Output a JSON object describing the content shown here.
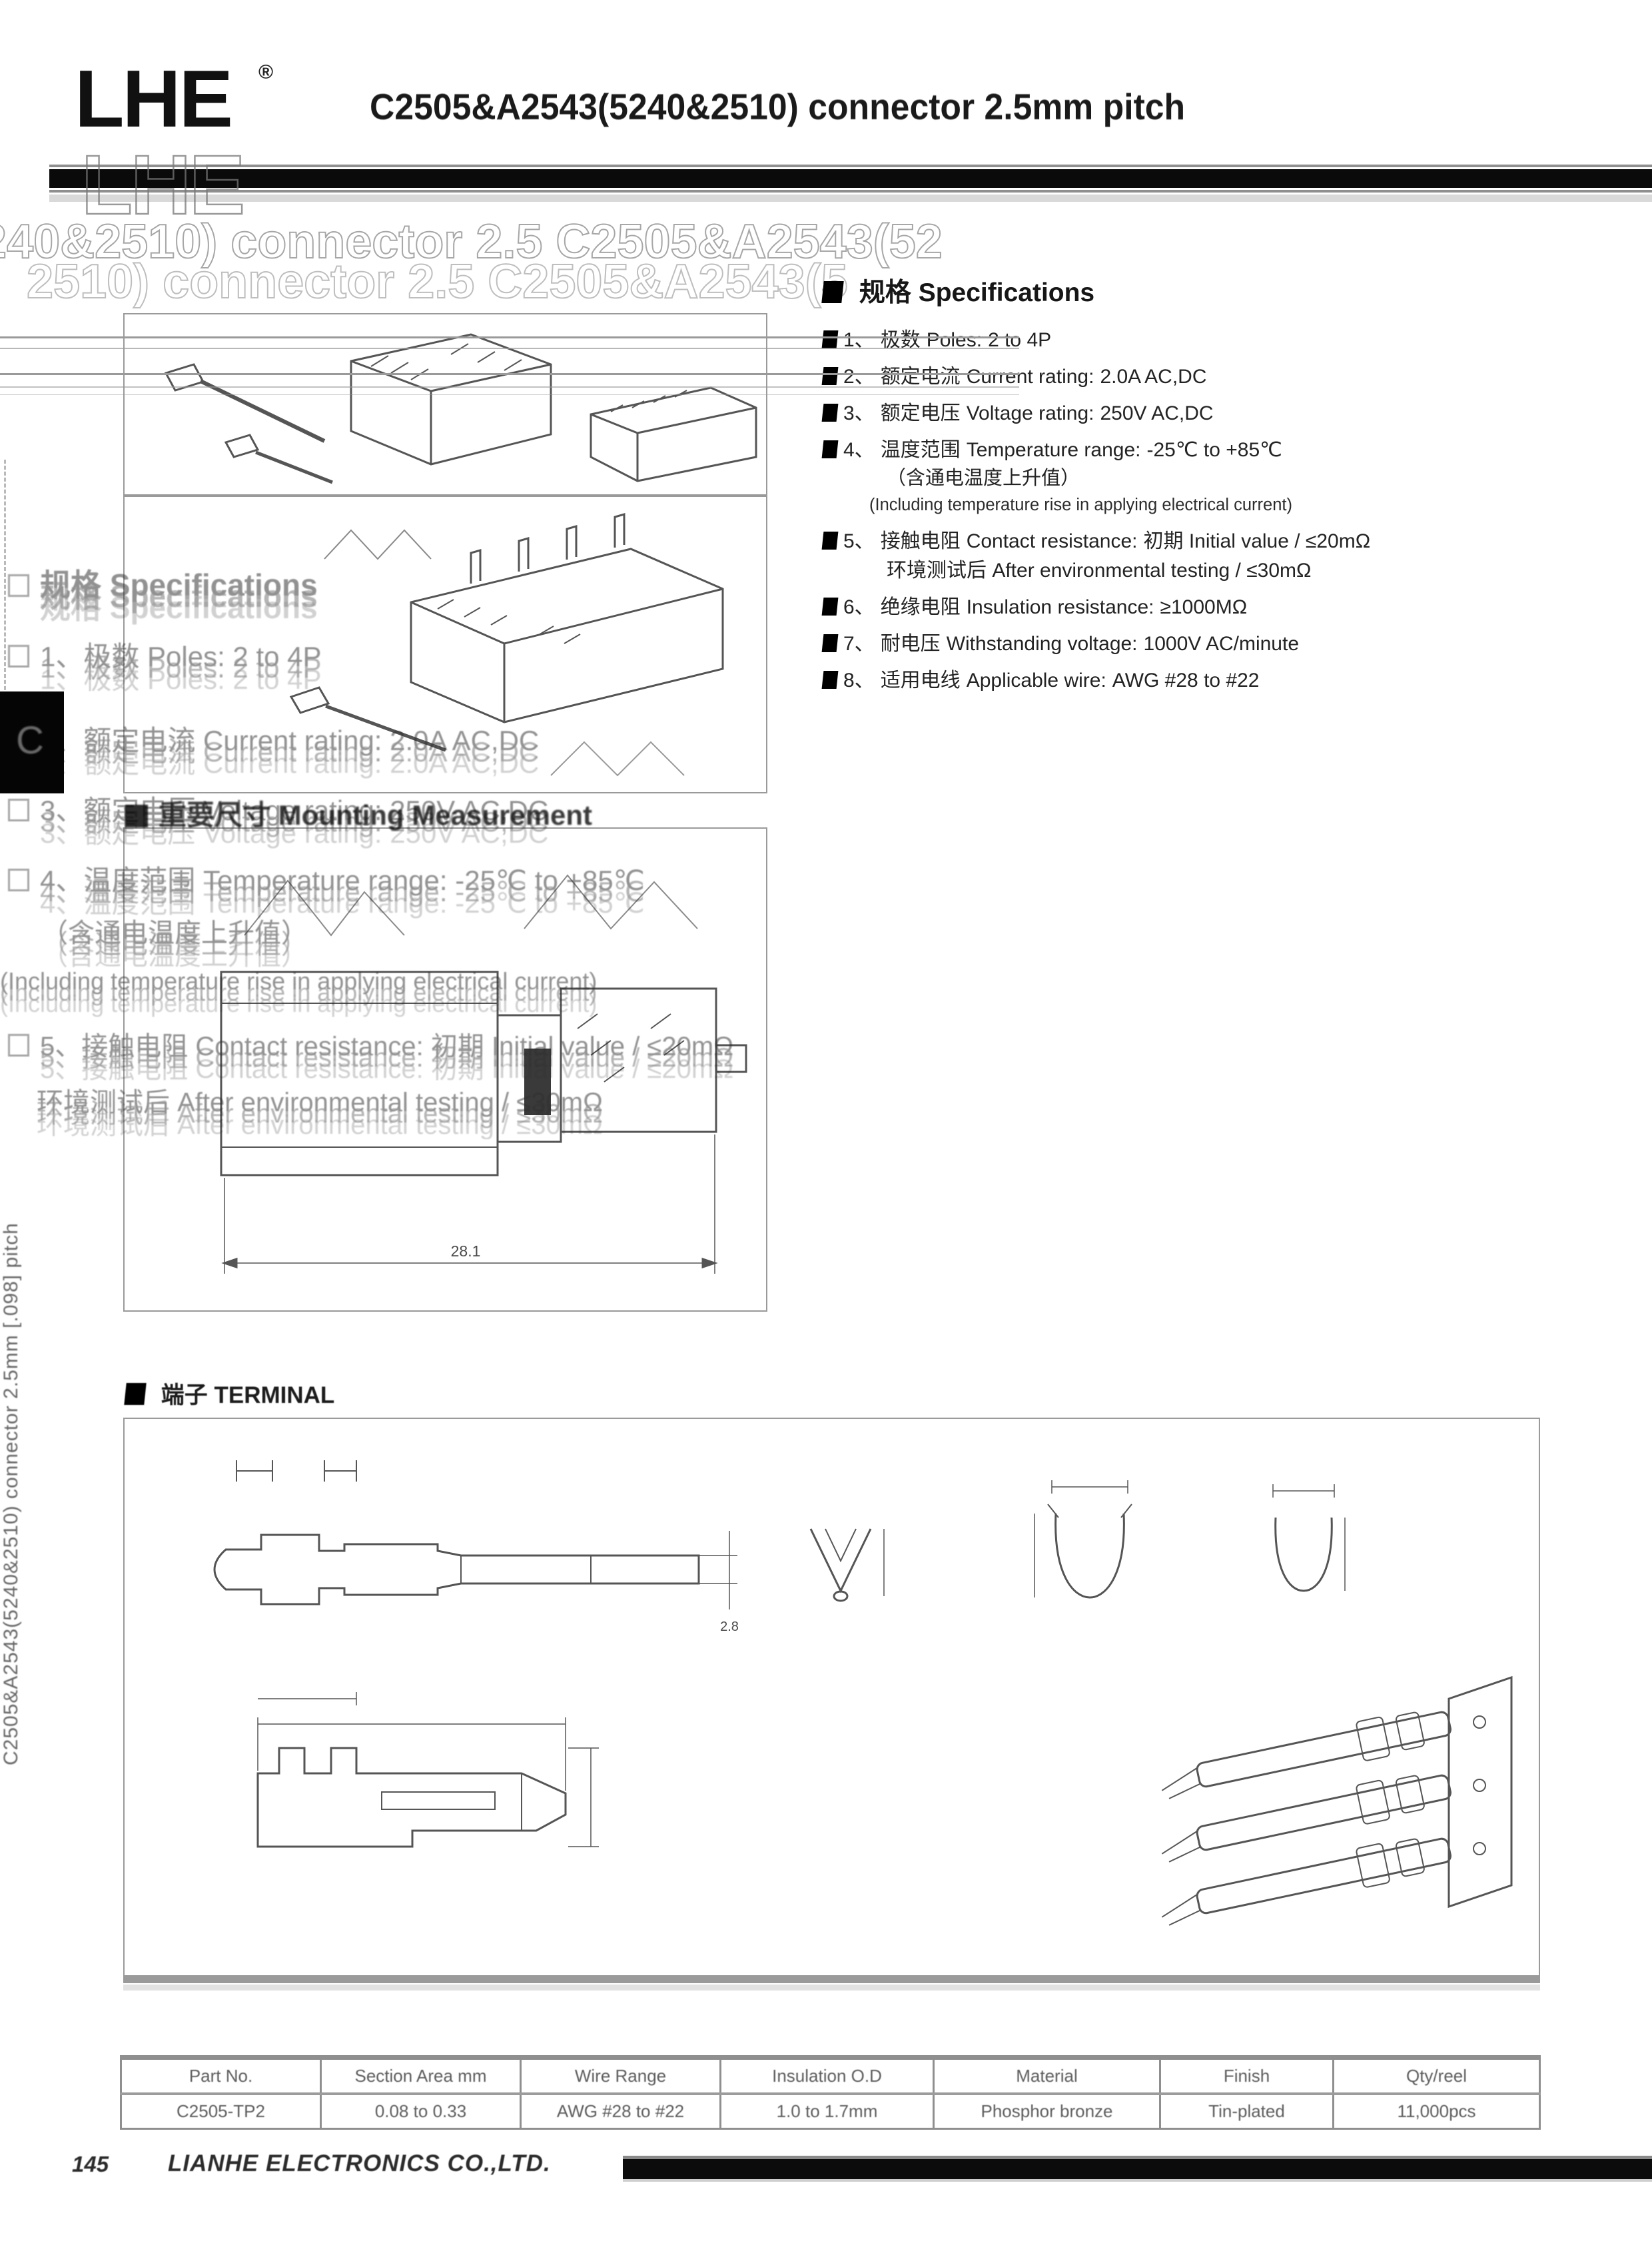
{
  "page": {
    "number": "145",
    "company": "LIANHE ELECTRONICS CO.,LTD."
  },
  "header": {
    "logo": "LHE",
    "registered": "®",
    "title": "C2505&A2543(5240&2510) connector 2.5mm pitch"
  },
  "ghosts": {
    "logo": "LHE",
    "title_line1": "240&2510) connector 2.5 C2505&A2543(52",
    "title_line2": "2510) connector 2.5 C2505&A2543(5",
    "mould_heading": "重要尺寸 Mounting Measurement",
    "spec_lines": [
      "规格 Specifications",
      "1、极数 Poles: 2 to 4P",
      "2、额定电流 Current rating: 2.0A AC,DC",
      "3、额定电压 Voltage rating: 250V AC,DC",
      "4、温度范围 Temperature range: -25℃ to +85℃",
      "（含通电温度上升值）",
      "(Including temperature rise in applying electrical current)",
      "5、接触电阻 Contact resistance: 初期 Initial value / ≤20mΩ",
      "环境测试后 After environmental testing / ≤30mΩ"
    ]
  },
  "sidebar": {
    "vertical_text": "C2505&A2543(5240&2510) connector 2.5mm [.098] pitch",
    "tab_glyph": "C"
  },
  "specifications": {
    "heading_zh": "规格",
    "heading_en": "Specifications",
    "items": [
      {
        "num": "1、",
        "zh": "极数",
        "en": "Poles:",
        "value": "2 to 4P"
      },
      {
        "num": "2、",
        "zh": "额定电流",
        "en": "Current rating:",
        "value": "2.0A AC,DC"
      },
      {
        "num": "3、",
        "zh": "额定电压",
        "en": "Voltage rating:",
        "value": "250V AC,DC"
      },
      {
        "num": "4、",
        "zh": "温度范围",
        "en": "Temperature range:",
        "value": "-25℃ to +85℃",
        "note_zh": "（含通电温度上升值）",
        "note_en": "(Including temperature rise in applying electrical current)"
      },
      {
        "num": "5、",
        "zh": "接触电阻",
        "en": "Contact resistance:",
        "value": "初期 Initial value / ≤20mΩ",
        "value2": "环境测试后 After environmental testing / ≤30mΩ"
      },
      {
        "num": "6、",
        "zh": "绝缘电阻",
        "en": "Insulation resistance:",
        "value": "≥1000MΩ"
      },
      {
        "num": "7、",
        "zh": "耐电压",
        "en": "Withstanding voltage:",
        "value": "1000V AC/minute"
      },
      {
        "num": "8、",
        "zh": "适用电线",
        "en": "Applicable wire:",
        "value": "AWG #28 to #22"
      }
    ]
  },
  "terminal_section": {
    "heading_zh": "端子",
    "heading_en": "TERMINAL"
  },
  "drawing": {
    "assembly_dim": "28.1",
    "pin_dim": "2.8"
  },
  "table": {
    "headers": [
      "Part No.",
      "Section Area mm",
      "Wire Range",
      "Insulation O.D",
      "Material",
      "Finish",
      "Qty/reel"
    ],
    "rows": [
      [
        "C2505-TP2",
        "0.08 to 0.33",
        "AWG #28 to #22",
        "1.0 to 1.7mm",
        "Phosphor bronze",
        "Tin-plated",
        "11,000pcs"
      ]
    ]
  }
}
